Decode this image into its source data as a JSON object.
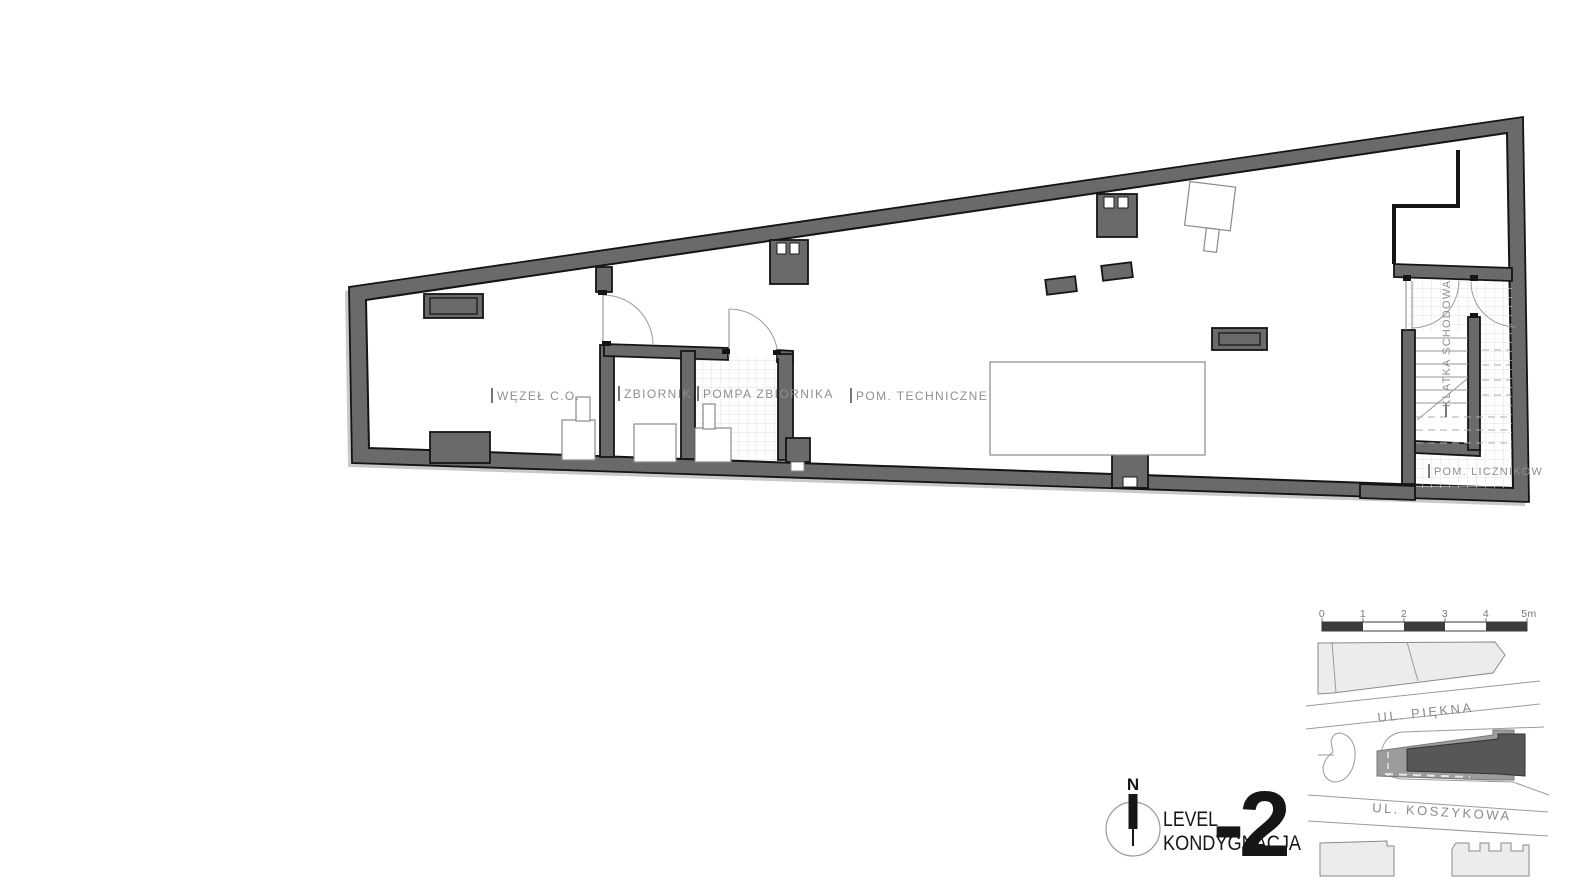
{
  "document": {
    "type": "architectural-floor-plan",
    "background": "#ffffff"
  },
  "plan": {
    "rooms": [
      {
        "id": "wezel-co",
        "label": "WĘZEŁ C.O."
      },
      {
        "id": "zbiornik",
        "label": "ZBIORNIK"
      },
      {
        "id": "pompa-zbiornika",
        "label": "POMPA ZBIORNIKA"
      },
      {
        "id": "pom-techniczne",
        "label": "POM. TECHNICZNE"
      },
      {
        "id": "klatka-schodowa",
        "label": "KLATKA SCHODOWA"
      },
      {
        "id": "pom-licznikow",
        "label": "POM. LICZNIKÓW"
      }
    ]
  },
  "scale_bar": {
    "unit_labels": [
      "0",
      "1",
      "2",
      "3",
      "4",
      "5m"
    ]
  },
  "site_map": {
    "street_top": "UL. PIĘKNA",
    "street_bottom": "UL. KOSZYKOWA"
  },
  "title_block": {
    "north_label": "N",
    "line1": "LEVEL",
    "line2": "KONDYGNACJA",
    "level_number": "-2"
  },
  "colors": {
    "wall_fill": "#6a6a6a",
    "outline": "#141414",
    "label_gray": "#8f8f8f",
    "tile_line": "#e3e3e3",
    "site_light": "#ececec",
    "site_mid": "#9c9c9c",
    "site_dark": "#575757",
    "scale_dark": "#3d3d3d"
  }
}
